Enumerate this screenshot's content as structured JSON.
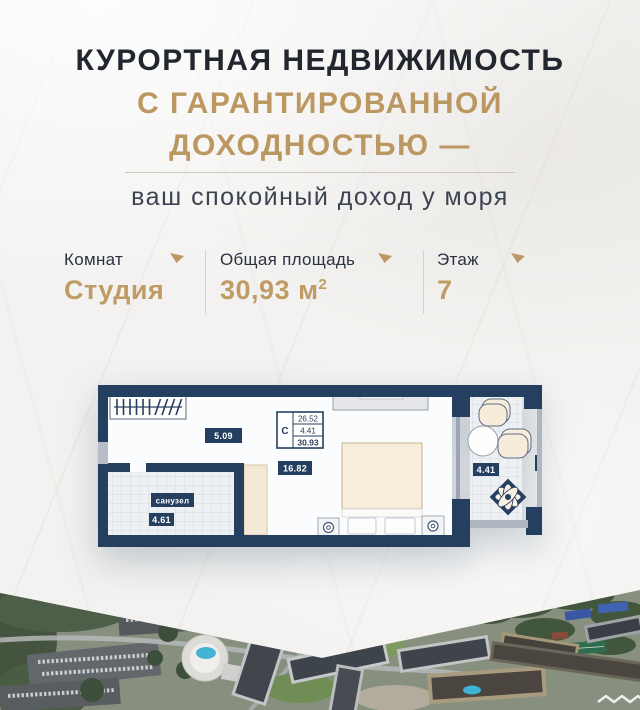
{
  "header": {
    "line1": "КУРОРТНАЯ НЕДВИЖИМОСТЬ",
    "line2": "С ГАРАНТИРОВАННОЙ",
    "line3": "ДОХОДНОСТЬЮ —",
    "subtitle": "ваш спокойный доход у моря"
  },
  "specs": [
    {
      "label": "Комнат",
      "value": "Студия"
    },
    {
      "label": "Общая площадь",
      "value": "30,93 м",
      "value_sup": "2"
    },
    {
      "label": "Этаж",
      "value": "7"
    }
  ],
  "floor_plan": {
    "hall_area": "5.09",
    "living_area": "16.82",
    "bathroom_label": "санузел",
    "bathroom_area": "4.61",
    "balcony_area": "4.41",
    "stamp": {
      "type": "С",
      "area_main": "26.52",
      "area_balcony": "4.41",
      "area_total": "30.93"
    }
  },
  "colors": {
    "gold": "#BC9964",
    "navy": "#243F60",
    "heading": "#22262E"
  }
}
